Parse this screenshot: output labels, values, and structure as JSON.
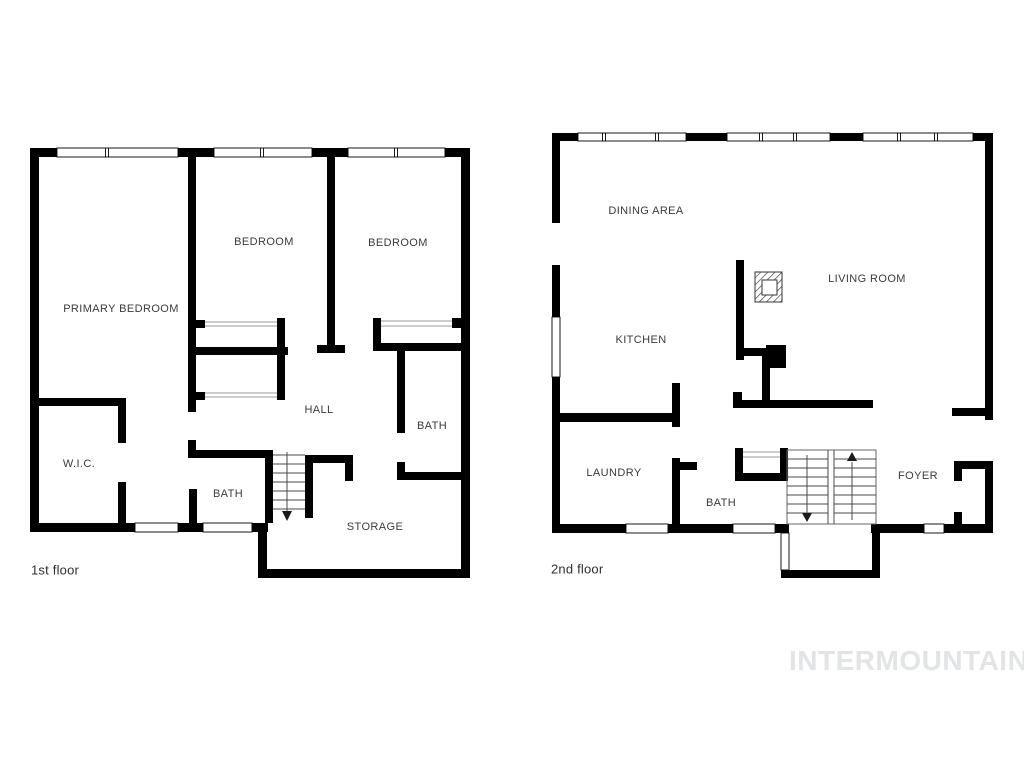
{
  "page": {
    "type": "floor-plan",
    "background": "#ffffff"
  },
  "colors": {
    "wall": "#000000",
    "room_label": "#3b3b3b",
    "caption": "#2e2e2e",
    "watermark": "#e2e4e6",
    "stair_tread": "#4a4a4a"
  },
  "watermark": {
    "text": "INTERMOUNTAIN"
  },
  "floor1": {
    "caption": "1st floor",
    "rooms": [
      {
        "id": "primary-bedroom",
        "label": "PRIMARY BEDROOM"
      },
      {
        "id": "bedroom-middle",
        "label": "BEDROOM"
      },
      {
        "id": "bedroom-right",
        "label": "BEDROOM"
      },
      {
        "id": "hall",
        "label": "HALL"
      },
      {
        "id": "bath-right",
        "label": "BATH"
      },
      {
        "id": "wic",
        "label": "W.I.C."
      },
      {
        "id": "bath-left",
        "label": "BATH"
      },
      {
        "id": "storage",
        "label": "STORAGE"
      }
    ],
    "stairs": {
      "direction": "down"
    }
  },
  "floor2": {
    "caption": "2nd floor",
    "rooms": [
      {
        "id": "dining-area",
        "label": "DINING AREA"
      },
      {
        "id": "living-room",
        "label": "LIVING ROOM"
      },
      {
        "id": "kitchen",
        "label": "KITCHEN"
      },
      {
        "id": "laundry",
        "label": "LAUNDRY"
      },
      {
        "id": "bath",
        "label": "BATH"
      },
      {
        "id": "foyer",
        "label": "FOYER"
      }
    ],
    "stairs": {
      "directions": [
        "down",
        "up"
      ]
    }
  }
}
